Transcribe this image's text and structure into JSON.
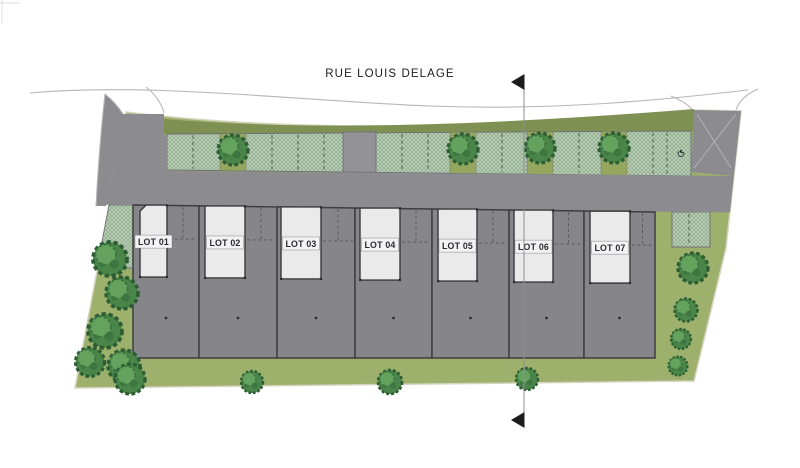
{
  "street": {
    "label": "RUE LOUIS DELAGE"
  },
  "lots": [
    {
      "label": "LOT 01"
    },
    {
      "label": "LOT 02"
    },
    {
      "label": "LOT 03"
    },
    {
      "label": "LOT 04"
    },
    {
      "label": "LOT 05"
    },
    {
      "label": "LOT 06"
    },
    {
      "label": "LOT 07"
    }
  ],
  "icons": {
    "section_marker": "black-left-triangle",
    "accessible_parking": "wheelchair-icon"
  },
  "colors": {
    "grass": "#9DB06C",
    "site_stroke": "#D6D4BE",
    "strip": "#7F9152",
    "hatch_bg": "#BACFB6",
    "hatch_line": "#86A484",
    "hatch_stroke": "#6E6E72",
    "planter": "#95A75F",
    "road": "#8C8C90",
    "walk": "#939397",
    "lot": "#86868A",
    "lot_stroke": "#3E3E42",
    "building": "#EAEAEB",
    "building_stroke": "#3A3A3E",
    "tree_fill": "#4A8549",
    "tree_mid": "#3C7340",
    "tree_light": "#64A35D",
    "tree_stroke": "#2C5C33",
    "ink": "#1C1C1C",
    "street_line": "#B6B6B6",
    "dash": "#4F5D49",
    "marker": "#2E2E32"
  },
  "plan": {
    "lot_dividers": [
      133,
      199,
      277,
      355,
      432,
      509,
      584,
      655
    ],
    "buildings": [
      [
        140,
        167
      ],
      [
        205,
        245
      ],
      [
        281,
        321
      ],
      [
        360,
        400
      ],
      [
        438,
        477
      ],
      [
        514,
        553
      ],
      [
        590,
        630
      ]
    ],
    "lot_top_left": 205,
    "lot_top_slope": 0.0134,
    "lot_bottom": 358,
    "building_height": 72,
    "rear_marker_y": 318,
    "bay_offset": 34,
    "chip": {
      "w": 37,
      "h": 13
    },
    "parking": {
      "x1": 167,
      "x2": 691,
      "dividers": [
        193,
        272,
        298,
        324,
        402,
        428,
        502,
        579,
        653,
        667
      ],
      "planters": [
        220,
        450,
        527,
        601
      ],
      "planter_w": 26,
      "handicap_xy": [
        681,
        151
      ]
    },
    "walkway": [
      343,
      376
    ],
    "side_hatch_left": [
      [
        133,
        205
      ],
      [
        133,
        268
      ],
      [
        97,
        268
      ],
      [
        109,
        205
      ]
    ],
    "side_hatch_right": {
      "x1": 672,
      "x2": 710,
      "y1": 212,
      "y2": 247,
      "div_x": 689
    },
    "trees": [
      [
        233,
        150,
        1.5
      ],
      [
        463,
        149,
        1.5
      ],
      [
        540,
        148,
        1.5
      ],
      [
        614,
        148,
        1.5
      ],
      [
        110,
        259,
        1.7
      ],
      [
        122,
        293,
        1.6
      ],
      [
        105,
        331,
        1.7
      ],
      [
        90,
        362,
        1.45
      ],
      [
        124,
        366,
        1.6
      ],
      [
        130,
        379,
        1.5
      ],
      [
        252,
        382,
        1.1
      ],
      [
        390,
        382,
        1.2
      ],
      [
        527,
        379,
        1.1
      ],
      [
        693,
        268,
        1.5
      ],
      [
        686,
        310,
        1.15
      ],
      [
        681,
        339,
        1.0
      ],
      [
        678,
        366,
        0.95
      ]
    ],
    "section_line": {
      "x": 524,
      "y1": 76,
      "y2": 424,
      "tri_top_y": 82,
      "tri_bot_y": 420
    }
  }
}
